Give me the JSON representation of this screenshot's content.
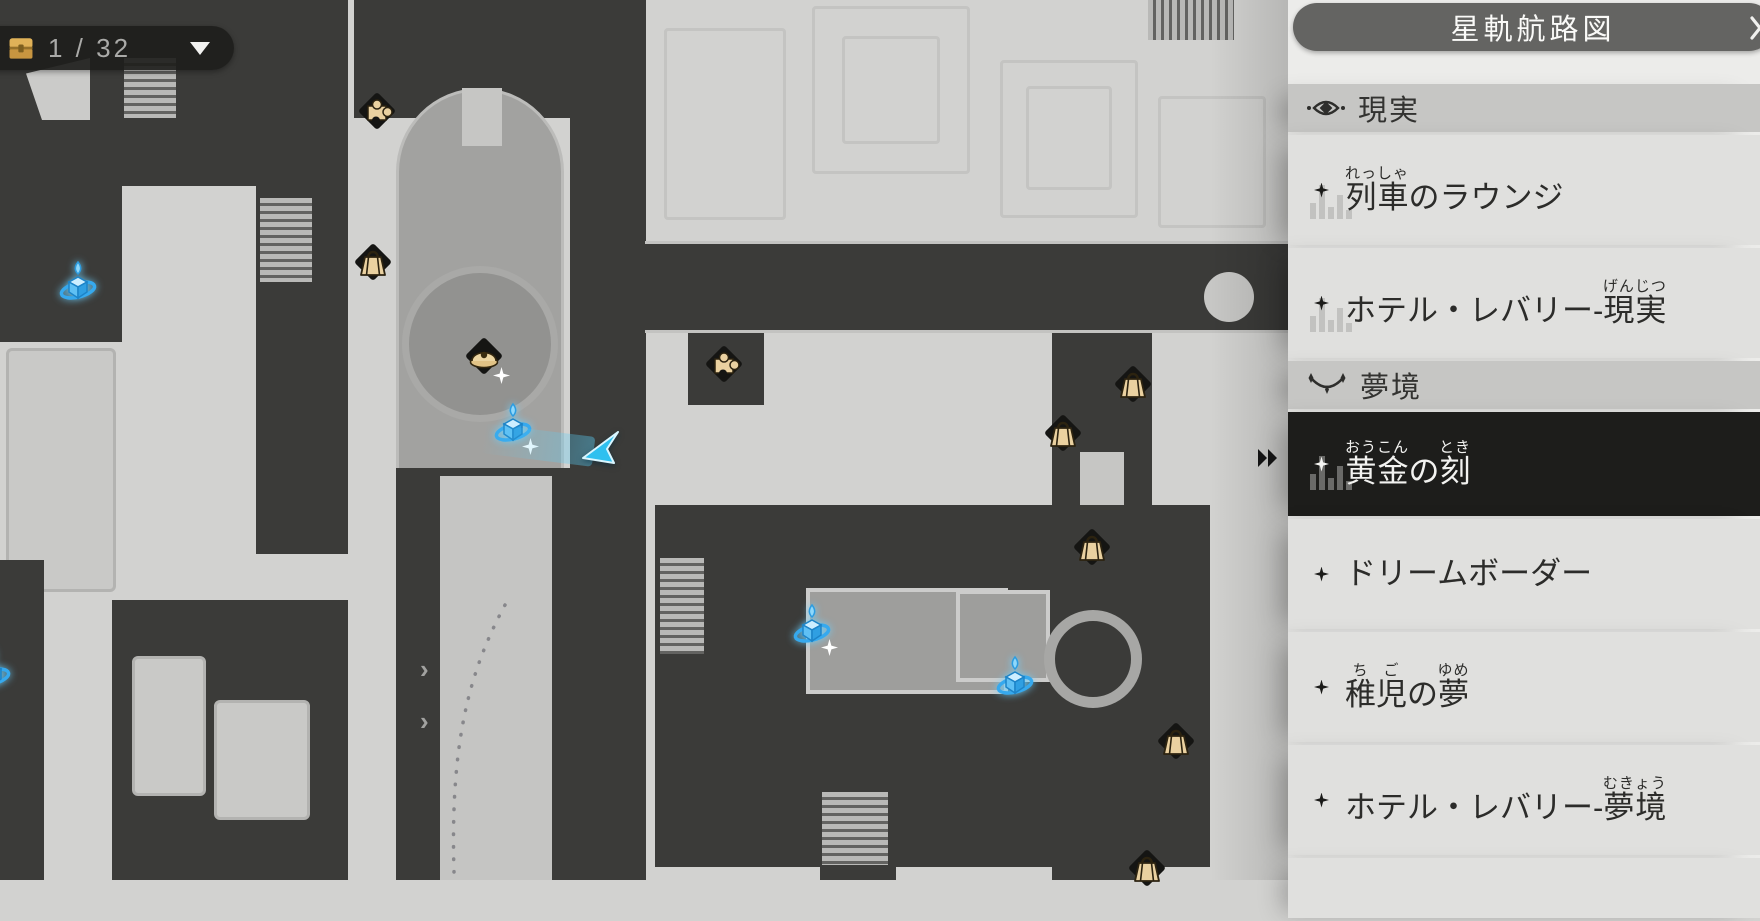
{
  "title_bar": {
    "title": "星軌航路図"
  },
  "counter": {
    "value": "1 / 32",
    "icon": "chest-icon"
  },
  "sidebar": {
    "sections": [
      {
        "type": "header",
        "id": "reality",
        "label": "現実",
        "icon": "eye-icon"
      },
      {
        "type": "item",
        "id": "train-lounge",
        "selected": false,
        "segments": [
          {
            "t": "列車",
            "r": "れっしゃ"
          },
          {
            "t": "のラウンジ"
          }
        ]
      },
      {
        "type": "item",
        "id": "hotel-reverie-reality",
        "selected": false,
        "segments": [
          {
            "t": "ホテル・レバリー-"
          },
          {
            "t": "現実",
            "r": "げんじつ"
          }
        ]
      },
      {
        "type": "header",
        "id": "dreamscape",
        "label": "夢境",
        "icon": "dream-icon"
      },
      {
        "type": "item",
        "id": "golden-hour",
        "selected": true,
        "segments": [
          {
            "t": "黄金",
            "r": "おうこん"
          },
          {
            "t": "の"
          },
          {
            "t": "刻",
            "r": "とき"
          }
        ]
      },
      {
        "type": "item",
        "id": "dream-border",
        "selected": false,
        "segments": [
          {
            "t": "ドリームボーダー"
          }
        ]
      },
      {
        "type": "item",
        "id": "childhood-dream",
        "selected": false,
        "segments": [
          {
            "t": "稚児",
            "r": "ちご"
          },
          {
            "t": "の"
          },
          {
            "t": "夢",
            "r": "ゆめ"
          }
        ]
      },
      {
        "type": "item",
        "id": "hotel-reverie-dream",
        "selected": false,
        "segments": [
          {
            "t": "ホテル・レバリー-"
          },
          {
            "t": "夢境",
            "r": "むきょう"
          }
        ]
      }
    ]
  },
  "map": {
    "markers": [
      {
        "type": "puzzle",
        "x": 377,
        "y": 111
      },
      {
        "type": "bag",
        "x": 373,
        "y": 262
      },
      {
        "type": "anchor",
        "x": 78,
        "y": 285
      },
      {
        "type": "npc",
        "x": 484,
        "y": 356,
        "sparkle": true
      },
      {
        "type": "anchor",
        "x": 513,
        "y": 427,
        "sparkle": true
      },
      {
        "type": "player",
        "x": 600,
        "y": 446
      },
      {
        "type": "puzzle",
        "x": 724,
        "y": 364
      },
      {
        "type": "bag",
        "x": 1133,
        "y": 384
      },
      {
        "type": "bag",
        "x": 1063,
        "y": 433
      },
      {
        "type": "bag",
        "x": 1092,
        "y": 547
      },
      {
        "type": "anchor",
        "x": 812,
        "y": 628,
        "sparkle": true
      },
      {
        "type": "anchor",
        "x": 1015,
        "y": 680
      },
      {
        "type": "bag",
        "x": 1176,
        "y": 741
      },
      {
        "type": "anchor",
        "x": -8,
        "y": 672
      },
      {
        "type": "bag",
        "x": 1147,
        "y": 868
      }
    ],
    "colors": {
      "accent_blue": "#3fa9f0",
      "marker_tan": "#ead1a0",
      "badge_black": "#151513"
    }
  }
}
